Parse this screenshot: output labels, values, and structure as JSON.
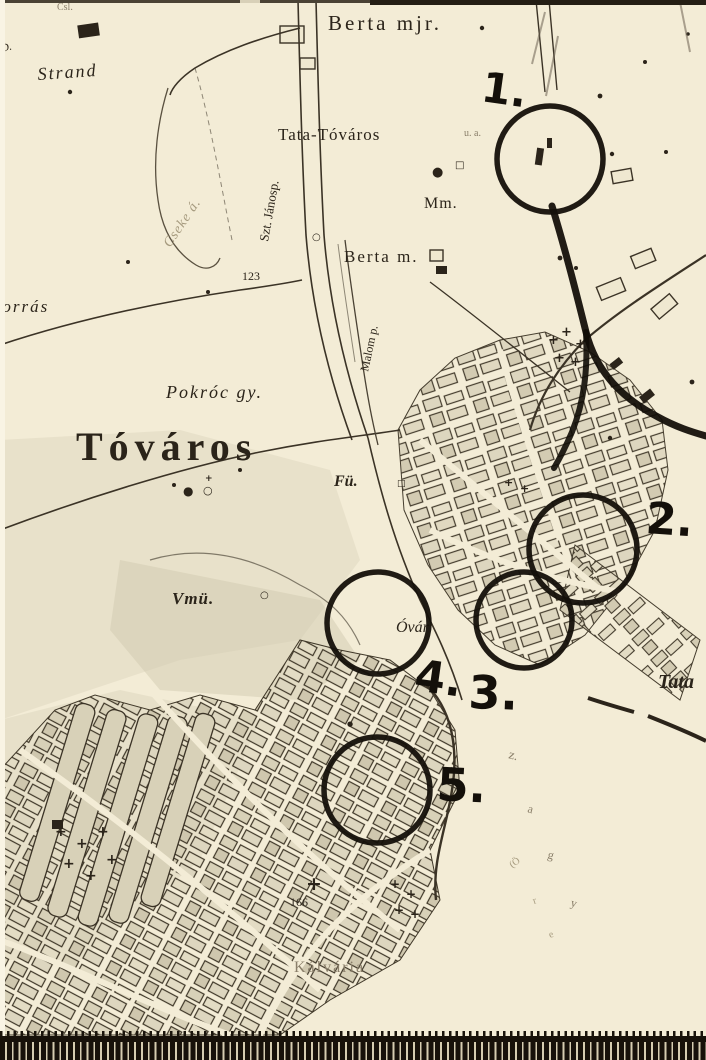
{
  "photo": {
    "description": "black-and-white photograph of an old town map of Tata-Tóváros with five hand-drawn circle markers",
    "colors": {
      "paper": "#f3ecd6",
      "ink": "#2b241a",
      "faded_ink": "#8a7f6a",
      "shading": "#cdc5ac",
      "marker_ink": "#14100a"
    },
    "bottom_ruler": {
      "style": "black band with light tick marks along bottom edge"
    }
  },
  "map": {
    "labels": [
      {
        "id": "csl",
        "text": "Csl.",
        "x": 57,
        "y": 10,
        "size": 10,
        "rot": 0,
        "cls": "faded"
      },
      {
        "id": "d",
        "text": "D.",
        "x": 2,
        "y": 52,
        "size": 11,
        "rot": -15,
        "cls": "italic"
      },
      {
        "id": "strand",
        "text": "Strand",
        "x": 38,
        "y": 80,
        "size": 18,
        "rot": -4,
        "cls": "italic sp2"
      },
      {
        "id": "berta-mjr",
        "text": "Berta mjr.",
        "x": 328,
        "y": 30,
        "size": 21,
        "rot": 0,
        "cls": "serif sp3"
      },
      {
        "id": "tata-tovaros",
        "text": "Tata-Tóváros",
        "x": 278,
        "y": 140,
        "size": 17,
        "rot": 0,
        "cls": "serif sp1"
      },
      {
        "id": "pu",
        "text": "u. a.",
        "x": 464,
        "y": 136,
        "size": 10,
        "rot": 0,
        "cls": "faded"
      },
      {
        "id": "mm",
        "text": "Mm.",
        "x": 424,
        "y": 208,
        "size": 16,
        "rot": 0,
        "cls": "serif sp1"
      },
      {
        "id": "szt-janos",
        "text": "Szt. Jánosp.",
        "x": 268,
        "y": 242,
        "size": 13,
        "rot": -80,
        "cls": "serif"
      },
      {
        "id": "e123",
        "text": "123",
        "x": 242,
        "y": 280,
        "size": 12,
        "rot": 0,
        "cls": "serif"
      },
      {
        "id": "berta-m",
        "text": "Berta m.",
        "x": 344,
        "y": 262,
        "size": 17,
        "rot": 0,
        "cls": "serif sp2"
      },
      {
        "id": "malom",
        "text": "Malom p.",
        "x": 368,
        "y": 372,
        "size": 12,
        "rot": -78,
        "cls": "serif"
      },
      {
        "id": "cseke",
        "text": "Cseke á.",
        "x": 170,
        "y": 248,
        "size": 14,
        "rot": -56,
        "cls": "italic faded2 sp1"
      },
      {
        "id": "forras",
        "text": "Forrás",
        "x": -10,
        "y": 312,
        "size": 17,
        "rot": 0,
        "cls": "italic sp2"
      },
      {
        "id": "pokroc",
        "text": "Pokróc gy.",
        "x": 166,
        "y": 398,
        "size": 18,
        "rot": 0,
        "cls": "italic sp2"
      },
      {
        "id": "tovaros",
        "text": "Tóváros",
        "x": 76,
        "y": 460,
        "size": 40,
        "rot": 0,
        "cls": "serif bold sp6"
      },
      {
        "id": "fu",
        "text": "Fü.",
        "x": 334,
        "y": 486,
        "size": 16,
        "rot": 0,
        "cls": "italic bold"
      },
      {
        "id": "vmu",
        "text": "Vmü.",
        "x": 172,
        "y": 604,
        "size": 17,
        "rot": 0,
        "cls": "italic bold sp1"
      },
      {
        "id": "ovar",
        "text": "Óvár",
        "x": 396,
        "y": 632,
        "size": 16,
        "rot": 0,
        "cls": "italic"
      },
      {
        "id": "tata",
        "text": "Tata",
        "x": 658,
        "y": 688,
        "size": 20,
        "rot": 0,
        "cls": "italic bold"
      },
      {
        "id": "e166",
        "text": "166",
        "x": 290,
        "y": 906,
        "size": 12,
        "rot": 0,
        "cls": "serif"
      },
      {
        "id": "kalvaria",
        "text": "Kálvária",
        "x": 294,
        "y": 972,
        "size": 16,
        "rot": 0,
        "cls": "serif sp2 faded"
      },
      {
        "id": "hw-z",
        "text": "z.",
        "x": 508,
        "y": 758,
        "size": 13,
        "rot": 15,
        "cls": "faded"
      },
      {
        "id": "hw-a",
        "text": "a",
        "x": 527,
        "y": 812,
        "size": 12,
        "rot": 15,
        "cls": "faded"
      },
      {
        "id": "hw-g",
        "text": "g",
        "x": 547,
        "y": 858,
        "size": 12,
        "rot": 15,
        "cls": "faded"
      },
      {
        "id": "hw-y",
        "text": "y",
        "x": 570,
        "y": 906,
        "size": 12,
        "rot": 15,
        "cls": "faded"
      },
      {
        "id": "hw-oreg",
        "text": "(Ö",
        "x": 512,
        "y": 868,
        "size": 10,
        "rot": -35,
        "cls": "faded2"
      },
      {
        "id": "hw-r",
        "text": "r",
        "x": 534,
        "y": 904,
        "size": 10,
        "rot": -20,
        "cls": "faded2"
      },
      {
        "id": "hw-e",
        "text": "e",
        "x": 550,
        "y": 938,
        "size": 10,
        "rot": -20,
        "cls": "faded2"
      }
    ],
    "markers": [
      {
        "label": "1.",
        "cx": 550,
        "cy": 159,
        "r": 53,
        "lx": 480,
        "ly": 101,
        "lrot": 8,
        "lsize": 42
      },
      {
        "label": "2.",
        "cx": 583,
        "cy": 549,
        "r": 54,
        "lx": 645,
        "ly": 533,
        "lrot": 4,
        "lsize": 44
      },
      {
        "label": "3.",
        "cx": 524,
        "cy": 620,
        "r": 48,
        "lx": 468,
        "ly": 708,
        "lrot": 2,
        "lsize": 46
      },
      {
        "label": "4.",
        "cx": 378,
        "cy": 623,
        "r": 51,
        "lx": 413,
        "ly": 690,
        "lrot": 8,
        "lsize": 44
      },
      {
        "label": "5.",
        "cx": 377,
        "cy": 790,
        "r": 53,
        "lx": 436,
        "ly": 800,
        "lrot": 3,
        "lsize": 46
      }
    ],
    "symbols": [
      {
        "name": "grave-cross-symbol",
        "glyph": "+",
        "x": 548,
        "y": 344,
        "size": 13
      },
      {
        "name": "grave-cross-symbol",
        "glyph": "+",
        "x": 561,
        "y": 336,
        "size": 13
      },
      {
        "name": "grave-cross-symbol",
        "glyph": "+",
        "x": 575,
        "y": 348,
        "size": 13
      },
      {
        "name": "grave-cross-symbol",
        "glyph": "+",
        "x": 554,
        "y": 362,
        "size": 13
      },
      {
        "name": "grave-cross-symbol",
        "glyph": "+",
        "x": 570,
        "y": 366,
        "size": 13
      },
      {
        "name": "grave-cross-symbol",
        "glyph": "+",
        "x": 55,
        "y": 836,
        "size": 14
      },
      {
        "name": "grave-cross-symbol",
        "glyph": "+",
        "x": 76,
        "y": 848,
        "size": 14
      },
      {
        "name": "grave-cross-symbol",
        "glyph": "+",
        "x": 97,
        "y": 836,
        "size": 14
      },
      {
        "name": "grave-cross-symbol",
        "glyph": "+",
        "x": 63,
        "y": 868,
        "size": 14
      },
      {
        "name": "grave-cross-symbol",
        "glyph": "+",
        "x": 85,
        "y": 880,
        "size": 14
      },
      {
        "name": "grave-cross-symbol",
        "glyph": "+",
        "x": 106,
        "y": 864,
        "size": 14
      },
      {
        "name": "grave-cross-symbol",
        "glyph": "+",
        "x": 390,
        "y": 888,
        "size": 12
      },
      {
        "name": "grave-cross-symbol",
        "glyph": "+",
        "x": 406,
        "y": 898,
        "size": 12
      },
      {
        "name": "grave-cross-symbol",
        "glyph": "+",
        "x": 394,
        "y": 914,
        "size": 12
      },
      {
        "name": "grave-cross-symbol",
        "glyph": "+",
        "x": 410,
        "y": 918,
        "size": 12
      },
      {
        "name": "grave-cross-symbol",
        "glyph": "+",
        "x": 504,
        "y": 486,
        "size": 11
      },
      {
        "name": "grave-cross-symbol",
        "glyph": "+",
        "x": 520,
        "y": 492,
        "size": 11
      },
      {
        "name": "calvary-cross-symbol",
        "glyph": "+",
        "x": 306,
        "y": 890,
        "size": 19
      },
      {
        "name": "building-dot-symbol",
        "glyph": "●",
        "x": 183,
        "y": 495,
        "size": 12
      },
      {
        "name": "chapel-ring-symbol",
        "glyph": "○",
        "x": 203,
        "y": 494,
        "size": 11
      },
      {
        "name": "grave-cross-symbol",
        "glyph": "+",
        "x": 205,
        "y": 481,
        "size": 9
      },
      {
        "name": "chapel-ring-symbol",
        "glyph": "○",
        "x": 260,
        "y": 598,
        "size": 10
      },
      {
        "name": "building-square-symbol",
        "glyph": "□",
        "x": 397,
        "y": 486,
        "size": 9
      },
      {
        "name": "mill-dot-symbol",
        "glyph": "●",
        "x": 432,
        "y": 176,
        "size": 13
      },
      {
        "name": "building-square-symbol",
        "glyph": "□",
        "x": 455,
        "y": 168,
        "size": 10
      },
      {
        "name": "chapel-ring-symbol",
        "glyph": "○",
        "x": 312,
        "y": 240,
        "size": 10
      },
      {
        "name": "building-dot-symbol",
        "glyph": "●",
        "x": 347,
        "y": 726,
        "size": 7
      }
    ]
  }
}
